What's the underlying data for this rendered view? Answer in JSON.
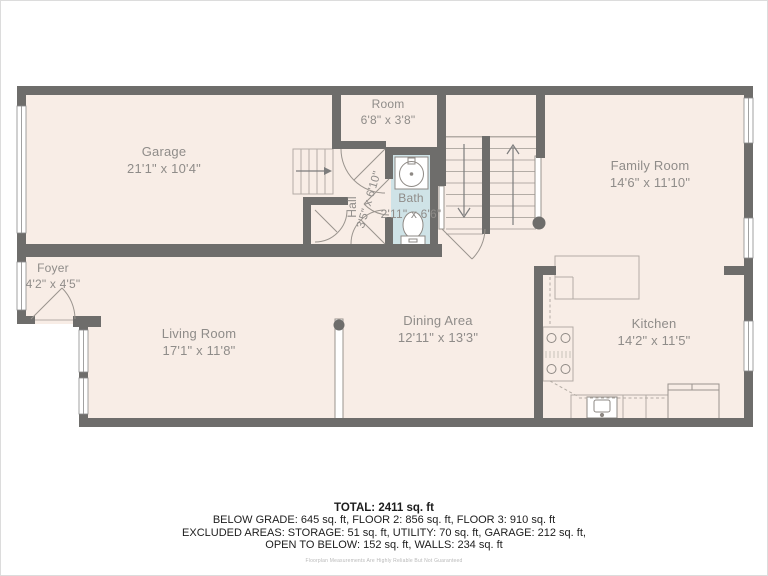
{
  "rooms": [
    {
      "name": "Garage",
      "dims": "21'1\" x 10'4\""
    },
    {
      "name": "Room",
      "dims": "6'8\" x 3'8\""
    },
    {
      "name": "Hall",
      "dims": "3'5\" x 6'10\""
    },
    {
      "name": "Bath",
      "dims": "2'11\" x 6'6\""
    },
    {
      "name": "Family Room",
      "dims": "14'6\" x 11'10\""
    },
    {
      "name": "Foyer",
      "dims": "4'2\" x 4'5\""
    },
    {
      "name": "Living Room",
      "dims": "17'1\" x 11'8\""
    },
    {
      "name": "Dining Area",
      "dims": "12'11\" x 13'3\""
    },
    {
      "name": "Kitchen",
      "dims": "14'2\" x 11'5\""
    }
  ],
  "summary": {
    "total": "TOTAL: 2411 sq. ft",
    "floors": "BELOW GRADE: 645 sq. ft, FLOOR 2: 856 sq. ft, FLOOR 3: 910 sq. ft",
    "excluded_line1": "EXCLUDED AREAS: STORAGE: 51 sq. ft, UTILITY: 70 sq. ft, GARAGE: 212 sq. ft,",
    "excluded_line2": "OPEN TO BELOW: 152 sq. ft, WALLS: 234 sq. ft"
  },
  "disclaimer": "Floorplan Measurements Are Highly Reliable But Not Guaranteed",
  "colors": {
    "floor": "#f8ede6",
    "wall": "#6e6d6b",
    "bath_floor": "#cfe3e7",
    "label_text": "#8f8c89",
    "summary_text": "#1d1d1d",
    "disclaimer_text": "#b9b9b9"
  }
}
